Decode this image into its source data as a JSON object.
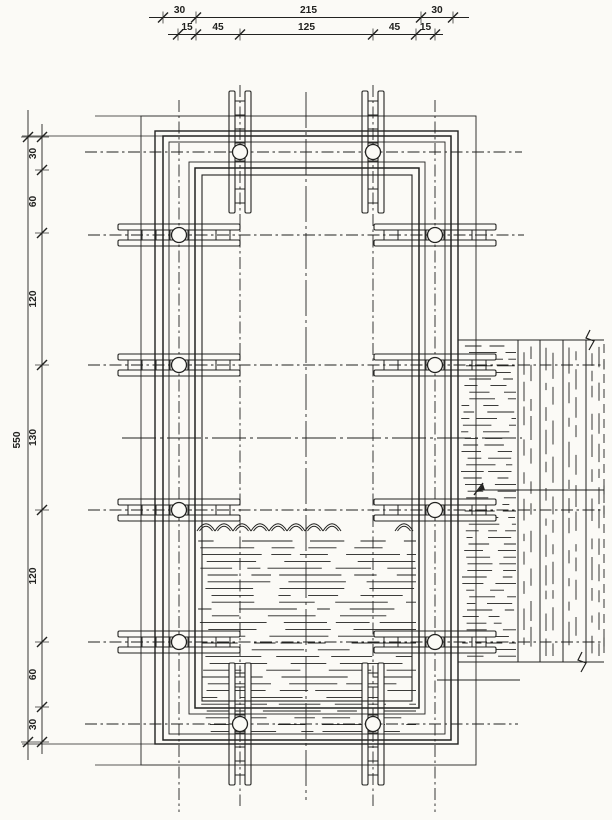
{
  "drawing": {
    "name": "formwork-clamp-plan",
    "background": "#fbfaf6",
    "line_color": "#222220",
    "dims": {
      "top_outer": [
        "30",
        "215",
        "30"
      ],
      "top_inner": [
        "15",
        "45",
        "125",
        "45",
        "15"
      ],
      "left_total": "550",
      "left_chain": [
        "30",
        "60",
        "120",
        "130",
        "120",
        "60",
        "30"
      ]
    }
  }
}
